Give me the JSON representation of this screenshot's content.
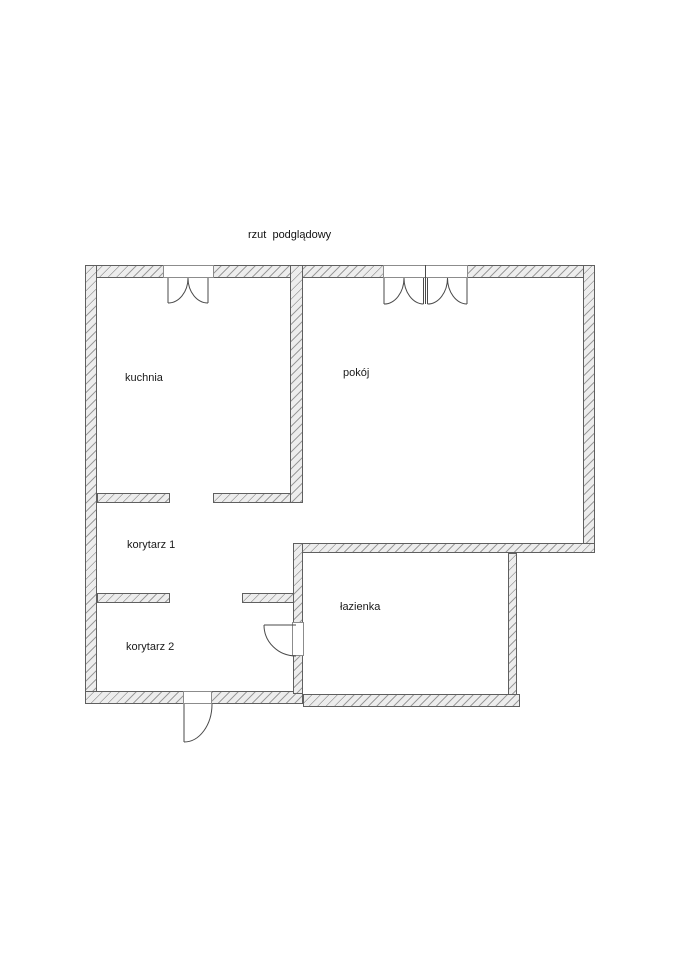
{
  "title": "rzut  podglądowy",
  "rooms": [
    {
      "id": "kuchnia",
      "label": "kuchnia"
    },
    {
      "id": "pokoj",
      "label": "pokój"
    },
    {
      "id": "korytarz-1",
      "label": "korytarz 1"
    },
    {
      "id": "korytarz-2",
      "label": "korytarz 2"
    },
    {
      "id": "lazienka",
      "label": "łazienka"
    }
  ],
  "doors": [
    {
      "name": "double-swing-door-kuchnia-top"
    },
    {
      "name": "double-double-swing-door-pokoj-top"
    },
    {
      "name": "swing-door-lazienka-left"
    },
    {
      "name": "swing-door-entrance-bottom"
    }
  ],
  "colors": {
    "background": "#ffffff",
    "wall_fill": "#ededed",
    "wall_hatch": "#9b9b9b",
    "wall_outline": "#5f5f5f",
    "door_line": "#4a4a4a",
    "text": "#1a1a1a"
  }
}
